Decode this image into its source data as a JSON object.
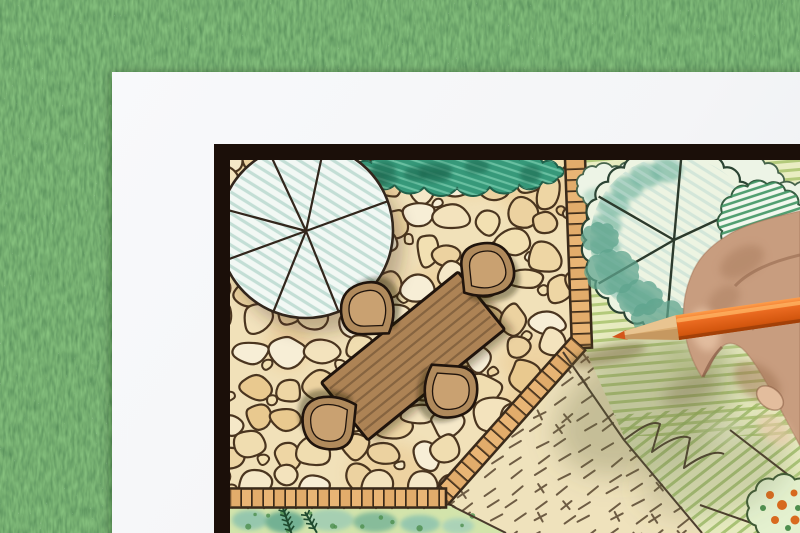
{
  "scene": {
    "description": "Overhead photo of a hand holding an orange colored pencil, drawing a backyard garden landscape-architecture plan on white paper lying on green grass.",
    "objects": [
      "grass-background",
      "paper-sheet",
      "plan-frame",
      "flagstone-patio",
      "garden-table",
      "garden-chairs",
      "round-tree-canopy-left",
      "hedge-strip",
      "paver-path",
      "lawn-area",
      "round-tree-canopy-right",
      "hatched-shrub",
      "stepping-area-dashes",
      "planting-bed",
      "flower-bed",
      "artist-hand",
      "orange-colored-pencil"
    ]
  },
  "colors": {
    "grassBase": "#4f7a40",
    "paper": "#f4f5f7",
    "paperEdge": "#e4e6e9",
    "frame": "#1b0f09",
    "planPaper": "#f6eed9",
    "patioBase": "#f1e1b9",
    "stoneLine": "#4a351f",
    "stoneFills": [
      "#f7eed6",
      "#f3e3bd",
      "#eed6a4",
      "#e9c98f",
      "#f5e8c8",
      "#f0ddb0",
      "#ecd2a0",
      "#f2e0b2"
    ],
    "stoneWarm": "#e9c286",
    "paver": "#e9b575",
    "paverLine": "#3a2a1a",
    "hedgeFill": "#37997a",
    "hedgeLine": "#20604a",
    "hedgeHatch": "#7ed0b2",
    "hedgeDark": "#1d6750",
    "treeFill": "#f2f8f4",
    "treeHatch": "#bedbd2",
    "inkLine": "#32261c",
    "lawnBase": "#e9edc2",
    "lawnStripe": "#a9c46f",
    "lawnStripe2": "#9cbb65",
    "lawnPatch": "#c9d795",
    "dashFill": "#efe2bc",
    "dashMark": "#6e5c44",
    "bedFill": "#d3e4ab",
    "bedLine": "#3c2c1c",
    "tealBlob": "#74b6a2",
    "conifer": "#1e4a2e",
    "cloudFill": "#edf4e6",
    "cloudLine": "#46634b",
    "shrubHatch": "#3f9563",
    "zigzag": "#4a3b2c",
    "flowerOrange": "#d96a1e",
    "flowerGreen": "#4e8f4e",
    "tableWood": "#ad8355",
    "tableSlat": "#7a5a3a",
    "chairRim": "#b08a5c",
    "chairSeat": "#c9a171",
    "furnitureLine": "#20140c",
    "skin": "#c89d7f",
    "skinShade": "#a87b5d",
    "skinLight": "#ecc9ab",
    "nail": "#e3bd9d",
    "pencilBody": "#ea6a20",
    "pencilLight": "#ffa14e",
    "pencilDark": "#b84a0c",
    "pencilWood": "#dcaf74",
    "pencilWoodLight": "#eac794",
    "pencilPoint": "#d4551a"
  }
}
